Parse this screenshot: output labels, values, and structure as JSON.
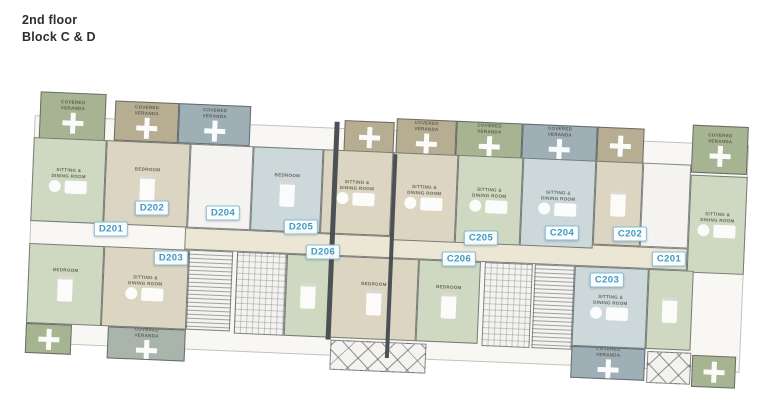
{
  "header": {
    "title": "2nd floor",
    "subtitle": "Block C & D"
  },
  "palette": {
    "wall": "#4c5155",
    "veranda_sage": "#a7b492",
    "veranda_tan": "#b6ad92",
    "veranda_bluegray": "#9fafb6",
    "veranda_graysage": "#a9b4ab",
    "room_green": "#cfd9c2",
    "room_beige": "#dbd5c1",
    "room_blue": "#ccd8da",
    "corridor": "#ece7d4",
    "white": "#f4f3f0",
    "badge_border": "#85bed8",
    "badge_text": "#3d9ac3"
  },
  "room_labels": {
    "veranda": "COVERED\nVERANDA",
    "living": "SITTING &\nDINING ROOM",
    "bedroom": "BEDROOM"
  },
  "units": [
    {
      "id": "D201",
      "x": 111,
      "y": 229
    },
    {
      "id": "D202",
      "x": 152,
      "y": 208
    },
    {
      "id": "D203",
      "x": 171,
      "y": 258
    },
    {
      "id": "D204",
      "x": 223,
      "y": 213
    },
    {
      "id": "D205",
      "x": 301,
      "y": 227
    },
    {
      "id": "D206",
      "x": 323,
      "y": 252
    },
    {
      "id": "C205",
      "x": 481,
      "y": 238
    },
    {
      "id": "C206",
      "x": 459,
      "y": 259
    },
    {
      "id": "C204",
      "x": 562,
      "y": 233
    },
    {
      "id": "C202",
      "x": 630,
      "y": 234
    },
    {
      "id": "C201",
      "x": 669,
      "y": 259
    },
    {
      "id": "C203",
      "x": 607,
      "y": 280
    }
  ],
  "plan": {
    "rotation_deg": 2.4,
    "pivot": [
      388,
      235
    ],
    "base": {
      "x": 30,
      "y": 130,
      "w": 715,
      "h": 228
    },
    "blocks": [
      {
        "x": 35,
        "y": 106,
        "w": 66,
        "h": 48,
        "fill": "veranda_sage",
        "label": "veranda",
        "furn": "cross",
        "name": "covered-veranda"
      },
      {
        "x": 110,
        "y": 112,
        "w": 64,
        "h": 40,
        "fill": "veranda_tan",
        "label": "veranda",
        "furn": "cross",
        "name": "covered-veranda"
      },
      {
        "x": 174,
        "y": 112,
        "w": 72,
        "h": 40,
        "fill": "veranda_bluegray",
        "label": "veranda",
        "furn": "cross",
        "name": "covered-veranda"
      },
      {
        "x": 340,
        "y": 122,
        "w": 50,
        "h": 32,
        "fill": "veranda_tan",
        "furn": "cross",
        "name": "covered-veranda"
      },
      {
        "x": 392,
        "y": 118,
        "w": 60,
        "h": 36,
        "fill": "veranda_tan",
        "label": "veranda",
        "furn": "cross",
        "name": "covered-veranda"
      },
      {
        "x": 452,
        "y": 118,
        "w": 66,
        "h": 36,
        "fill": "veranda_sage",
        "label": "veranda",
        "furn": "cross",
        "name": "covered-veranda"
      },
      {
        "x": 518,
        "y": 118,
        "w": 75,
        "h": 36,
        "fill": "veranda_bluegray",
        "label": "veranda",
        "furn": "cross",
        "name": "covered-veranda"
      },
      {
        "x": 593,
        "y": 118,
        "w": 47,
        "h": 36,
        "fill": "veranda_tan",
        "furn": "cross",
        "name": "covered-veranda"
      },
      {
        "x": 688,
        "y": 112,
        "w": 56,
        "h": 48,
        "fill": "veranda_sage",
        "label": "veranda",
        "furn": "cross",
        "name": "covered-veranda"
      },
      {
        "x": 185,
        "y": 236,
        "w": 503,
        "h": 22,
        "fill": "corridor",
        "name": "corridor"
      },
      {
        "x": 30,
        "y": 152,
        "w": 73,
        "h": 84,
        "fill": "room_green",
        "label": "living",
        "furn": "dining",
        "name": "room-living"
      },
      {
        "x": 103,
        "y": 152,
        "w": 84,
        "h": 84,
        "fill": "room_beige",
        "label": "bedroom",
        "furn": "bed",
        "name": "room-bedroom"
      },
      {
        "x": 187,
        "y": 152,
        "w": 63,
        "h": 84,
        "fill": "white",
        "name": "room-utility"
      },
      {
        "x": 250,
        "y": 152,
        "w": 70,
        "h": 84,
        "fill": "room_blue",
        "label": "bedroom",
        "furn": "bed",
        "name": "room-bedroom"
      },
      {
        "x": 320,
        "y": 152,
        "w": 70,
        "h": 84,
        "fill": "room_beige",
        "label": "living",
        "furn": "dining",
        "name": "room-living"
      },
      {
        "x": 390,
        "y": 152,
        "w": 65,
        "h": 88,
        "fill": "room_beige",
        "label": "living",
        "furn": "dining",
        "name": "room-living"
      },
      {
        "x": 455,
        "y": 152,
        "w": 65,
        "h": 88,
        "fill": "room_green",
        "label": "living",
        "furn": "dining",
        "name": "room-living"
      },
      {
        "x": 520,
        "y": 152,
        "w": 73,
        "h": 88,
        "fill": "room_blue",
        "label": "living",
        "furn": "dining",
        "name": "room-living"
      },
      {
        "x": 593,
        "y": 152,
        "w": 47,
        "h": 84,
        "fill": "room_beige",
        "furn": "bed",
        "name": "room-bedroom"
      },
      {
        "x": 640,
        "y": 152,
        "w": 48,
        "h": 84,
        "fill": "white",
        "name": "room-utility"
      },
      {
        "x": 688,
        "y": 162,
        "w": 57,
        "h": 98,
        "fill": "room_green",
        "label": "living",
        "furn": "dining",
        "name": "room-living"
      },
      {
        "x": 30,
        "y": 258,
        "w": 75,
        "h": 80,
        "fill": "room_green",
        "label": "bedroom",
        "furn": "bed",
        "name": "room-bedroom"
      },
      {
        "x": 105,
        "y": 258,
        "w": 85,
        "h": 80,
        "fill": "room_beige",
        "label": "living",
        "furn": "dining",
        "name": "room-living"
      },
      {
        "x": 190,
        "y": 258,
        "w": 44,
        "h": 80,
        "fill": "white",
        "hatch": "stairs",
        "name": "stair-core"
      },
      {
        "x": 238,
        "y": 258,
        "w": 50,
        "h": 82,
        "fill": "white",
        "hatch": "grid",
        "name": "lightwell"
      },
      {
        "x": 288,
        "y": 258,
        "w": 44,
        "h": 82,
        "fill": "room_green",
        "furn": "bed",
        "name": "room-bedroom"
      },
      {
        "x": 332,
        "y": 258,
        "w": 88,
        "h": 82,
        "fill": "room_beige",
        "label": "bedroom",
        "furn": "bed",
        "name": "room-bedroom"
      },
      {
        "x": 420,
        "y": 258,
        "w": 62,
        "h": 82,
        "fill": "room_green",
        "label": "bedroom",
        "furn": "bed",
        "name": "room-bedroom"
      },
      {
        "x": 486,
        "y": 258,
        "w": 48,
        "h": 84,
        "fill": "white",
        "hatch": "grid",
        "name": "lightwell"
      },
      {
        "x": 536,
        "y": 258,
        "w": 40,
        "h": 84,
        "fill": "white",
        "hatch": "stairs",
        "name": "stair-core"
      },
      {
        "x": 576,
        "y": 258,
        "w": 74,
        "h": 80,
        "fill": "room_blue",
        "label": "living",
        "furn": "dining",
        "name": "room-living"
      },
      {
        "x": 650,
        "y": 258,
        "w": 45,
        "h": 80,
        "fill": "room_green",
        "furn": "bed",
        "name": "room-bedroom"
      },
      {
        "x": 30,
        "y": 338,
        "w": 46,
        "h": 30,
        "fill": "veranda_sage",
        "furn": "cross",
        "name": "covered-veranda"
      },
      {
        "x": 112,
        "y": 338,
        "w": 78,
        "h": 32,
        "fill": "veranda_graysage",
        "label": "veranda",
        "furn": "cross",
        "name": "covered-veranda"
      },
      {
        "x": 335,
        "y": 342,
        "w": 96,
        "h": 30,
        "fill": "white",
        "hatch": "x",
        "name": "open-truss"
      },
      {
        "x": 652,
        "y": 340,
        "w": 44,
        "h": 32,
        "fill": "white",
        "hatch": "x",
        "name": "open-truss"
      },
      {
        "x": 576,
        "y": 338,
        "w": 74,
        "h": 32,
        "fill": "veranda_bluegray",
        "label": "veranda",
        "furn": "cross",
        "name": "covered-veranda"
      },
      {
        "x": 697,
        "y": 342,
        "w": 44,
        "h": 32,
        "fill": "veranda_sage",
        "furn": "cross",
        "name": "covered-veranda"
      },
      {
        "x": 330,
        "y": 124,
        "w": 5,
        "h": 218,
        "fill": "wall",
        "name": "expansion-joint"
      },
      {
        "x": 390,
        "y": 154,
        "w": 4,
        "h": 204,
        "fill": "wall",
        "name": "expansion-joint"
      }
    ]
  }
}
